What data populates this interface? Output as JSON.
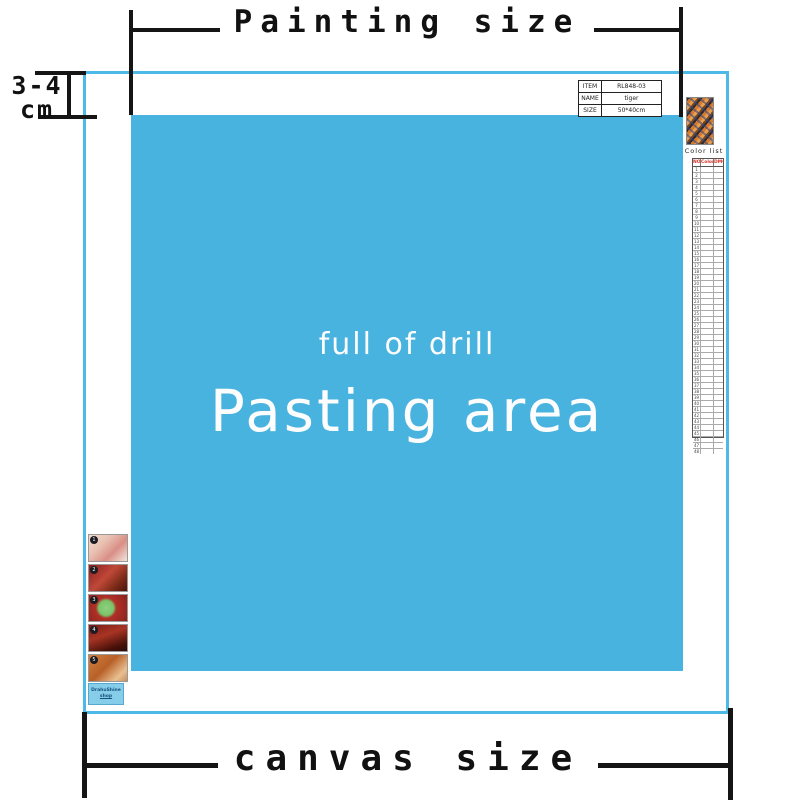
{
  "measurements": {
    "painting_size_label": "Painting size",
    "canvas_size_label": "canvas size",
    "margin_line1": "3-4",
    "margin_line2": "cm"
  },
  "pasting_area": {
    "subtitle": "full of drill",
    "title": "Pasting area",
    "bg_color": "#49b3e0",
    "border_color": "#4db9e6",
    "text_color": "#fdfdfd"
  },
  "info_table": {
    "rows": [
      {
        "label": "ITEM",
        "value": "RL848-03"
      },
      {
        "label": "NAME",
        "value": "tiger"
      },
      {
        "label": "SIZE",
        "value": "50*40cm"
      }
    ]
  },
  "color_list": {
    "title": "Color list",
    "headers": [
      "NO",
      "Color",
      "DMC"
    ],
    "header_color": "#d93025",
    "row_numbers": [
      "1",
      "2",
      "3",
      "4",
      "5",
      "6",
      "7",
      "8",
      "9",
      "10",
      "11",
      "12",
      "13",
      "14",
      "15",
      "16",
      "17",
      "18",
      "19",
      "20",
      "21",
      "22",
      "23",
      "24",
      "25",
      "26",
      "27",
      "28",
      "29",
      "30",
      "31",
      "32",
      "33",
      "34",
      "35",
      "36",
      "37",
      "38",
      "39",
      "40",
      "41",
      "42",
      "43",
      "44",
      "45",
      "46",
      "47",
      "48"
    ]
  },
  "steps": {
    "numbers": [
      "1",
      "2",
      "3",
      "4",
      "5"
    ]
  },
  "shop_box": {
    "line1": "DrahuShine",
    "line2": "shop"
  },
  "instructions": {
    "text_color": "#ea4a2f",
    "lines": [
      "1.Refer to the comparison table on the canvas to identify each diamond number which corresponds to a printed area on the canvas.",
      "2.Insert the round end of the drilling pen into the drilling cement,push hard,otherwise the cement may fall off.",
      "3.Use the round end to stick a diamond and slightly press down to get the extra cement out.",
      "4.Tear apart the partial film and stick the diamond to the canvas according to the corresponding number.",
      "5.After finished,slightly press down diamonds with hand to leave them firmly attached."
    ]
  }
}
